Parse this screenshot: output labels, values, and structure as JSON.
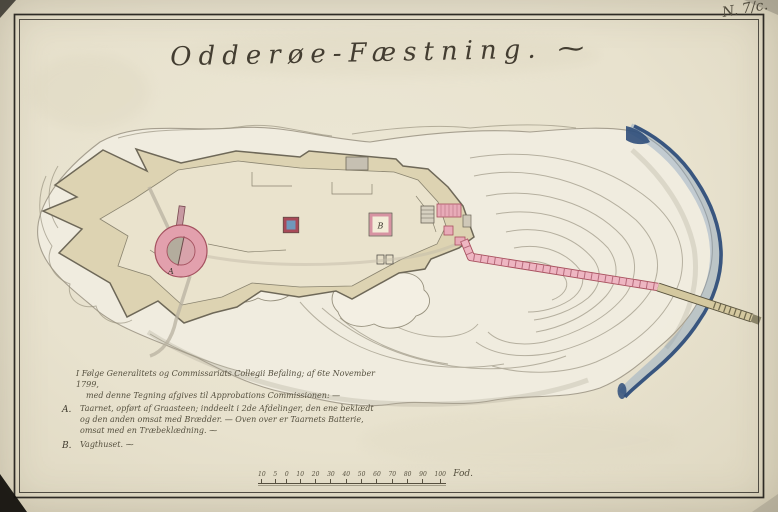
{
  "sheet": {
    "corner_note": "N. 7/c.",
    "title": "Odderøe-Fæstning. ⁓"
  },
  "legend": {
    "intro": [
      "I Følge Generalitets og Commissariats Collegii Befaling; af 6te November 1799,",
      "med denne Tegning afgives til Approbations Commissionen: —"
    ],
    "items": [
      {
        "key": "A.",
        "text": "Taarnet, opført af Graasteen; inddeelt i 2de Afdelinger, den ene beklædt og den anden omsat med Brædder. — Oven over er Taarnets Batterie, omsat med en Træbeklædning. ⁓"
      },
      {
        "key": "B.",
        "text": "Vagthuset. ⁓"
      }
    ]
  },
  "map_labels": {
    "tower": "A",
    "guardhouse": "B"
  },
  "scale_bar": {
    "ticks": [
      "10",
      "5",
      "0",
      "10",
      "20",
      "30",
      "40",
      "50",
      "60",
      "70",
      "80",
      "90",
      "100"
    ],
    "unit": "Fod."
  },
  "colors": {
    "paper": "#e8e2ce",
    "ink": "#433d31",
    "fort_fill": "#ddd3b2",
    "fort_inner": "#eae3cd",
    "wall_stroke": "#6e6858",
    "rock_line": "#96907d",
    "pink": "#e2a0ad",
    "crimson": "#a8505e",
    "causeway_pink": "#eeb6c2",
    "pier_tan": "#d4c89f",
    "water_dark": "#2f4e7a",
    "water_light": "#8aa3c2",
    "magazine_blue": "#6f98bb"
  }
}
